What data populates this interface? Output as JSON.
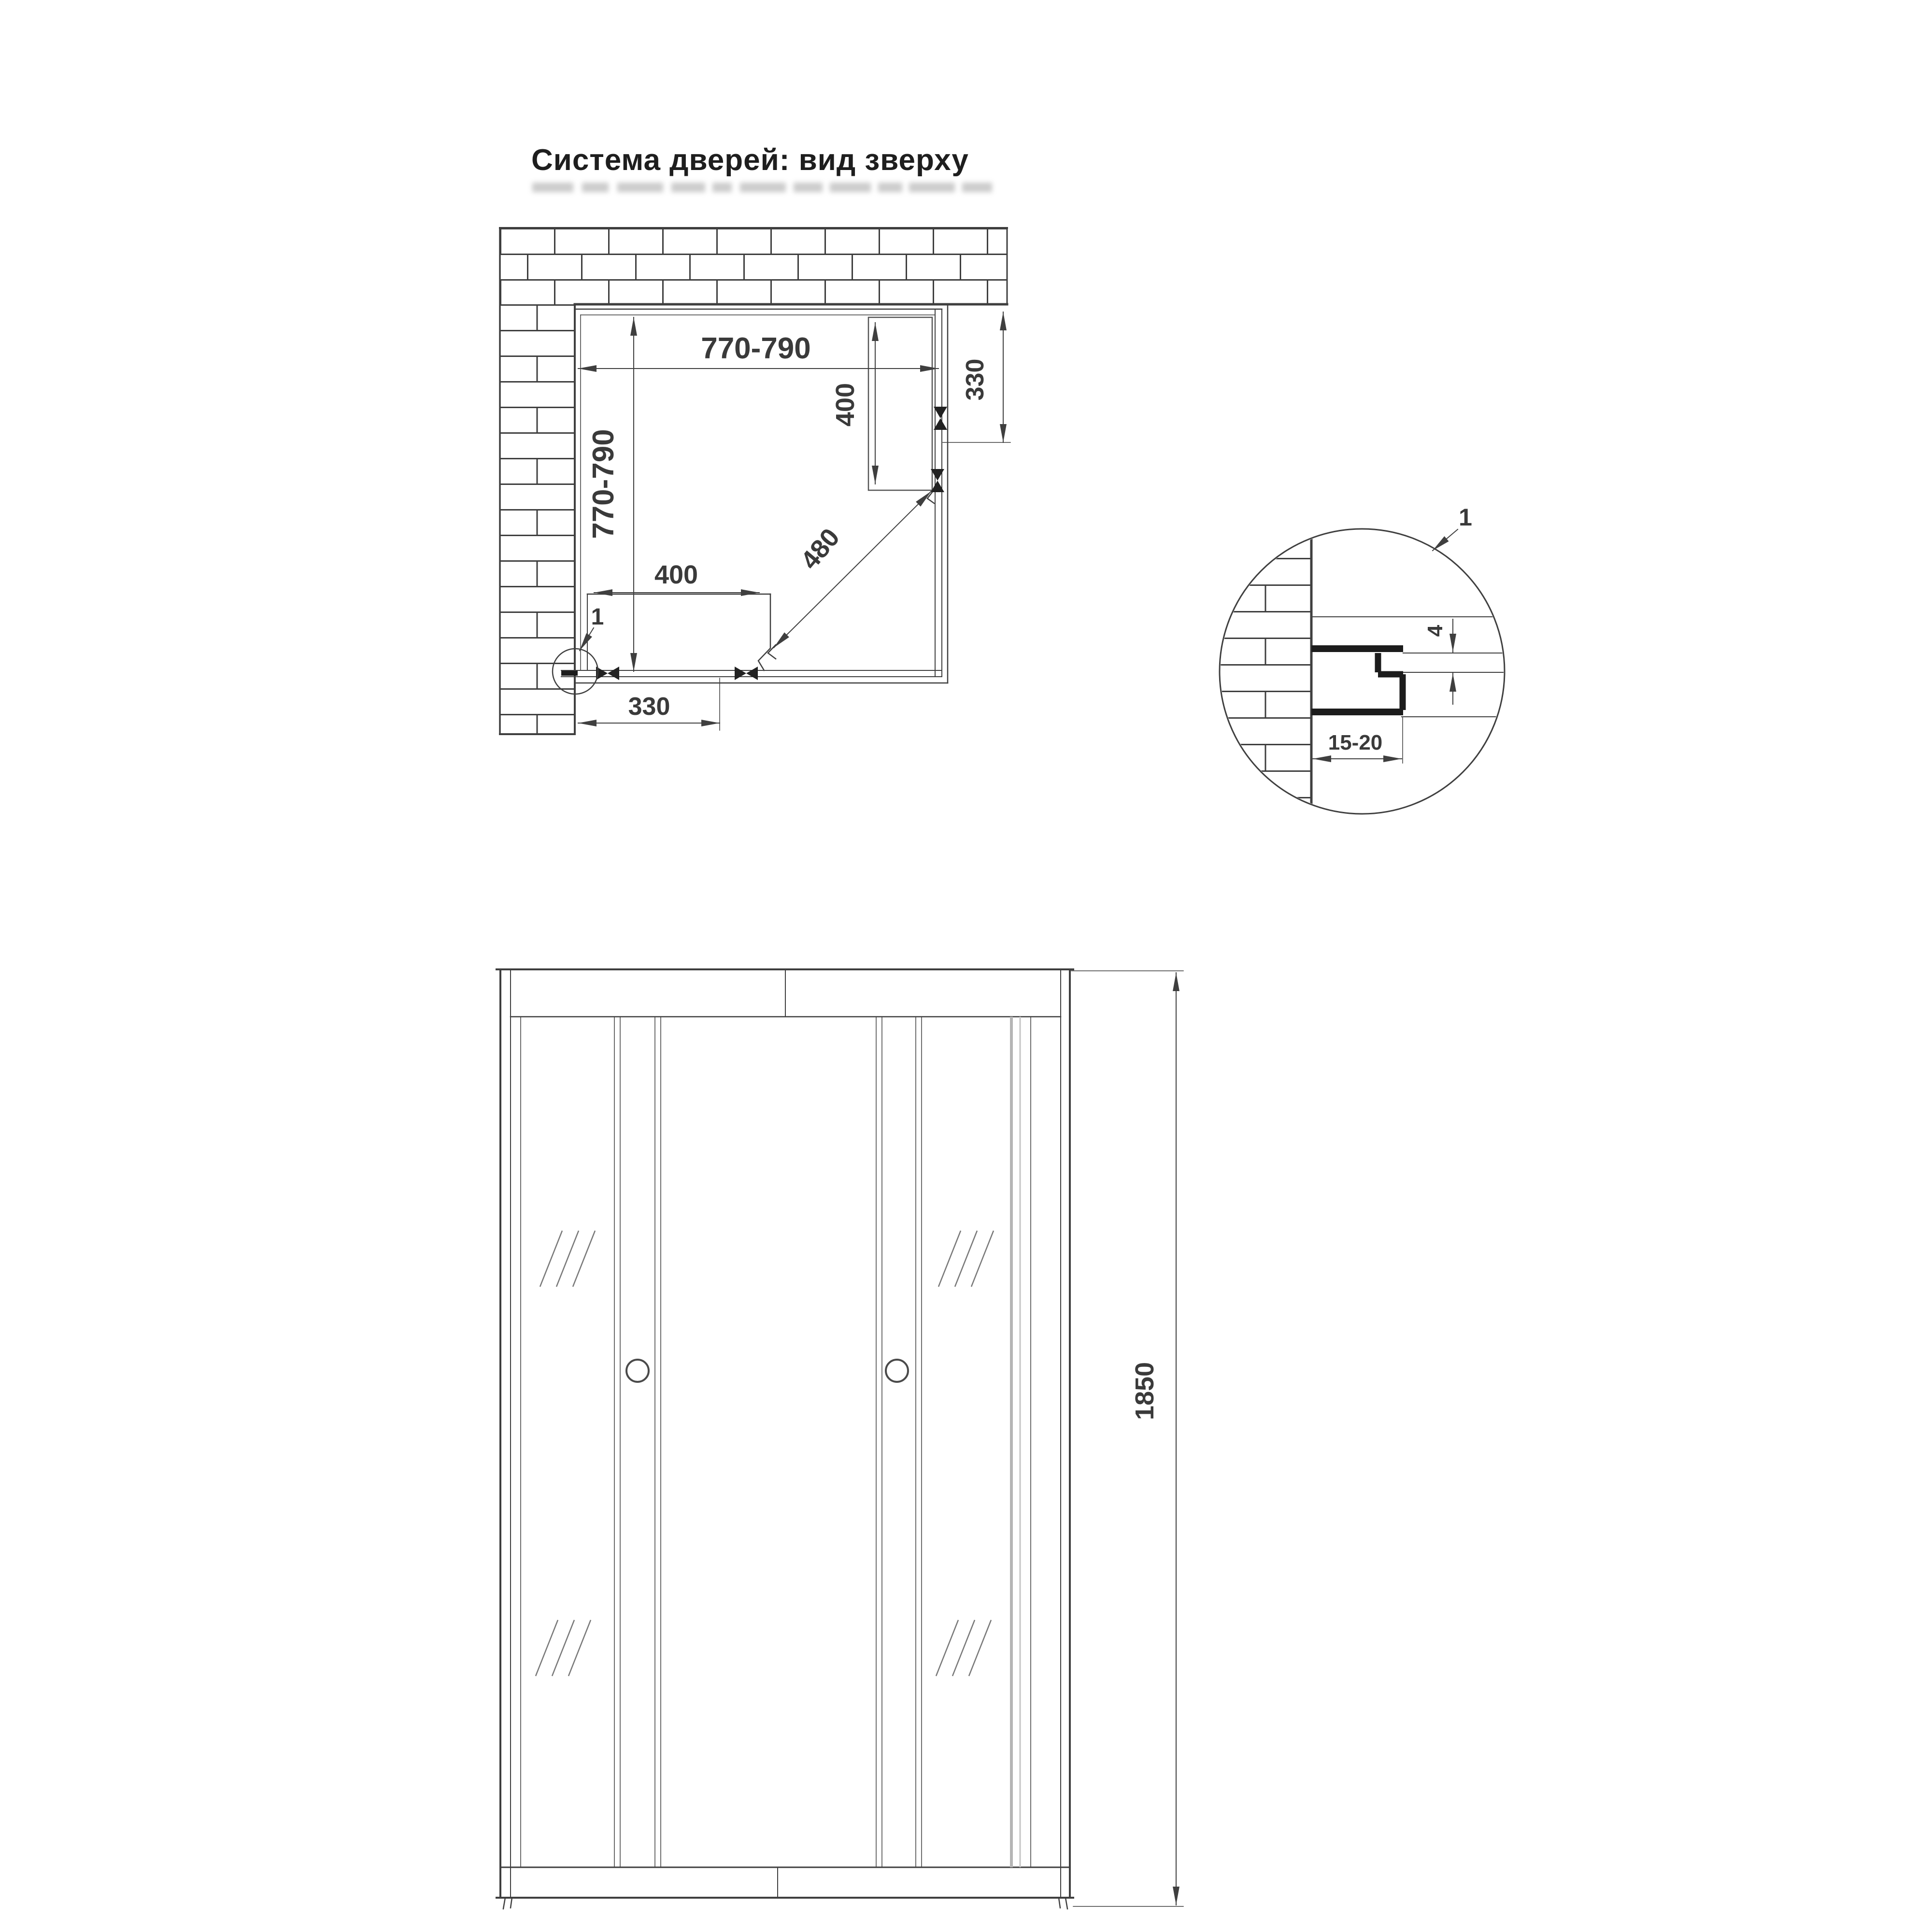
{
  "title": "Система дверей: вид зверху",
  "colors": {
    "ink": "#3f3f3f",
    "profile_ink": "#1c1c1c",
    "glass_gray": "#b5b5b5"
  },
  "plan_view": {
    "dim_width_top": "770-790",
    "dim_depth_left": "770-790",
    "dim_side_panel_length": "400",
    "dim_side_opening": "330",
    "dim_door_diagonal": "480",
    "dim_bottom_panel_length": "400",
    "dim_bottom_opening": "330",
    "detail_callout": "1"
  },
  "detail_view": {
    "callout": "1",
    "dim_glass_thickness": "4",
    "dim_wall_clearance": "15-20"
  },
  "front_view": {
    "dim_height": "1850"
  }
}
